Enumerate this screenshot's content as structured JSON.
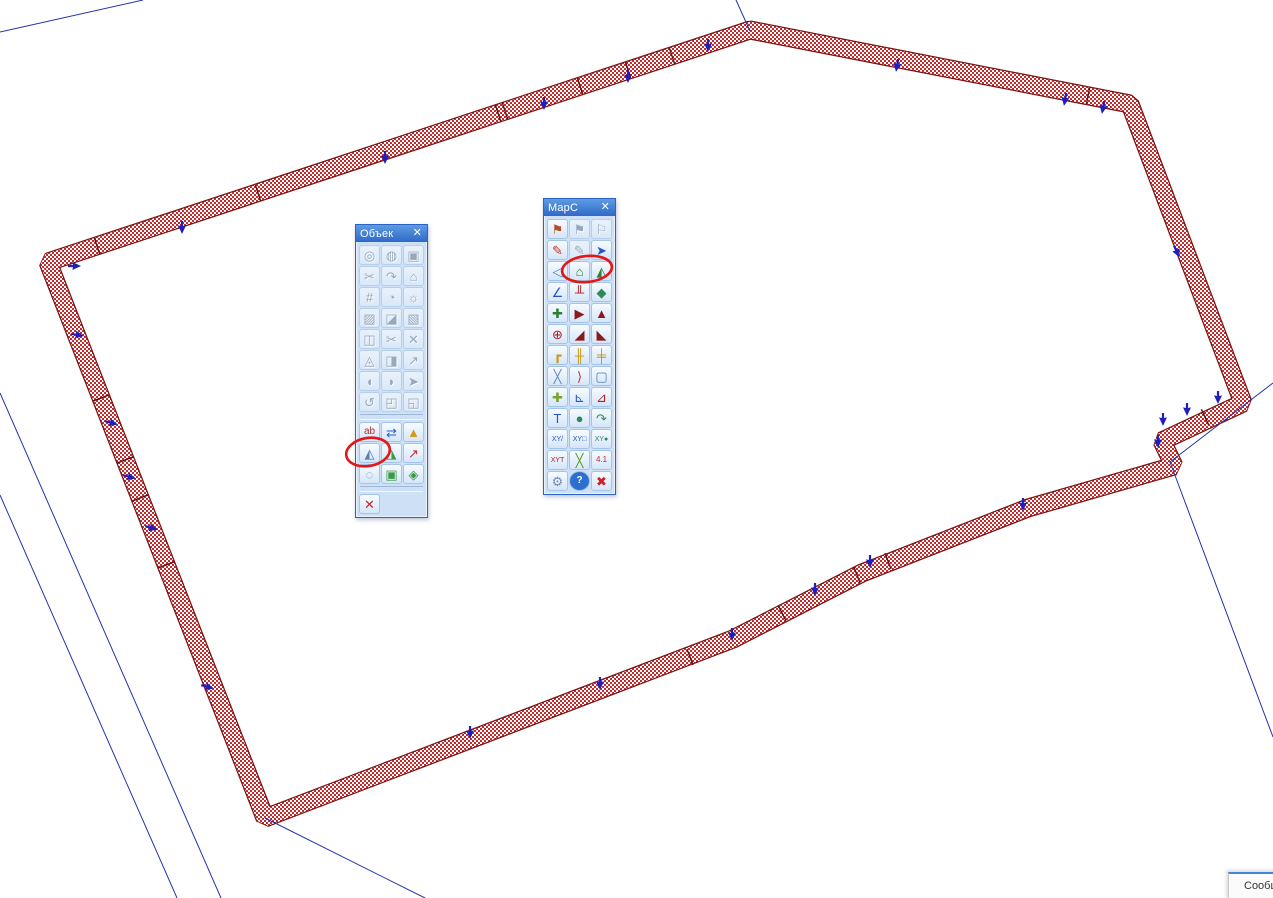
{
  "map": {
    "background": "#ffffff",
    "band": {
      "width": 16.5,
      "hatch_color": "#c42a2a",
      "outline_color": "#7a1414"
    },
    "polygon_points": [
      [
        48,
        262
      ],
      [
        750,
        30
      ],
      [
        1130,
        104
      ],
      [
        1243,
        403
      ],
      [
        1162,
        441
      ],
      [
        1174,
        466
      ],
      [
        1028,
        508
      ],
      [
        862,
        573
      ],
      [
        733,
        639
      ],
      [
        265,
        818
      ]
    ],
    "ticks": [
      [
        97,
        246,
        -18
      ],
      [
        258,
        193,
        -18
      ],
      [
        498,
        113,
        -18
      ],
      [
        505,
        111,
        -18
      ],
      [
        580,
        86,
        -18
      ],
      [
        628,
        70,
        -18
      ],
      [
        672,
        56,
        -18
      ],
      [
        1088,
        96,
        11
      ],
      [
        1205,
        417,
        155
      ],
      [
        888,
        561,
        159
      ],
      [
        857,
        575,
        159
      ],
      [
        782,
        613,
        153
      ],
      [
        690,
        657,
        159
      ],
      [
        101,
        398,
        69
      ],
      [
        125,
        460,
        69
      ],
      [
        140,
        498,
        69
      ],
      [
        166,
        565,
        69
      ]
    ],
    "tick_color": "#5d1010",
    "arrows": [
      [
        75,
        266,
        -90
      ],
      [
        78,
        335,
        -80
      ],
      [
        112,
        423,
        -75
      ],
      [
        130,
        477,
        -75
      ],
      [
        152,
        528,
        -75
      ],
      [
        208,
        687,
        -75
      ],
      [
        182,
        228,
        0
      ],
      [
        385,
        158,
        0
      ],
      [
        544,
        104,
        0
      ],
      [
        628,
        77,
        0
      ],
      [
        708,
        46,
        0
      ],
      [
        897,
        66,
        10
      ],
      [
        1065,
        100,
        10
      ],
      [
        1103,
        108,
        10
      ],
      [
        1177,
        252,
        -25
      ],
      [
        1218,
        398,
        0
      ],
      [
        1187,
        410,
        0
      ],
      [
        1163,
        420,
        0
      ],
      [
        1158,
        442,
        0
      ],
      [
        1023,
        505,
        0
      ],
      [
        870,
        562,
        0
      ],
      [
        815,
        590,
        0
      ],
      [
        732,
        635,
        0
      ],
      [
        600,
        684,
        0
      ],
      [
        470,
        733,
        0
      ]
    ],
    "arrow_color": "#1f1fbe",
    "blue_lines": [
      [
        0,
        32,
        143,
        0
      ],
      [
        736,
        0,
        750,
        31
      ],
      [
        0,
        393,
        221,
        898
      ],
      [
        0,
        495,
        177,
        898
      ],
      [
        265,
        818,
        425,
        898
      ],
      [
        1273,
        383,
        1170,
        462
      ],
      [
        1170,
        462,
        1273,
        737
      ]
    ],
    "line_color": "#2233aa",
    "annotations": {
      "color": "#e21717",
      "ellipses": [
        [
          368,
          452,
          22,
          14,
          -10
        ],
        [
          587,
          269,
          25,
          13,
          -6
        ]
      ]
    }
  },
  "toolbars": [
    {
      "title": "Объек",
      "close_glyph": "✕",
      "x": 355,
      "y": 224,
      "w": 71,
      "rows": [
        {
          "icons": [
            {
              "n": "center-point-icon",
              "g": "◎",
              "d": 1
            },
            {
              "n": "hatched-circle-icon",
              "g": "◍",
              "d": 1
            },
            {
              "n": "copy-object-icon",
              "g": "▣",
              "d": 1
            }
          ]
        },
        {
          "icons": [
            {
              "n": "cut-object-icon",
              "g": "✂",
              "d": 1
            },
            {
              "n": "smooth-arc-icon",
              "g": "↷",
              "d": 1
            },
            {
              "n": "move-contour-icon",
              "g": "⌂",
              "d": 1
            }
          ]
        },
        {
          "icons": [
            {
              "n": "grid-icon",
              "g": "#",
              "d": 1
            },
            {
              "n": "fill-area-icon",
              "g": "◔",
              "d": 1
            },
            {
              "n": "gear-area-icon",
              "g": "☼",
              "d": 1
            }
          ]
        },
        {
          "icons": [
            {
              "n": "hatch-square-icon",
              "g": "▨",
              "d": 1
            },
            {
              "n": "hatch-corner-icon",
              "g": "◪",
              "d": 1
            },
            {
              "n": "hatch-diag-icon",
              "g": "▧",
              "d": 1
            }
          ]
        },
        {
          "icons": [
            {
              "n": "frame-edit-icon",
              "g": "◫",
              "d": 1
            },
            {
              "n": "cut-line-icon",
              "g": "✂",
              "d": 1
            },
            {
              "n": "delete-node-icon",
              "g": "✕",
              "d": 1
            }
          ]
        },
        {
          "icons": [
            {
              "n": "query-area-icon",
              "g": "◬",
              "d": 1
            },
            {
              "n": "merge-area-icon",
              "g": "◨",
              "d": 1
            },
            {
              "n": "split-line-icon",
              "g": "↗",
              "d": 1
            }
          ]
        },
        {
          "icons": [
            {
              "n": "contour-left-icon",
              "g": "◖",
              "d": 1
            },
            {
              "n": "contour-right-icon",
              "g": "◗",
              "d": 1
            },
            {
              "n": "contour-arrow-icon",
              "g": "➤",
              "d": 1
            }
          ]
        },
        {
          "icons": [
            {
              "n": "undo-contour-icon",
              "g": "↺",
              "d": 1
            },
            {
              "n": "copy-frame-icon",
              "g": "◰",
              "d": 1
            },
            {
              "n": "paste-frame-icon",
              "g": "◱",
              "d": 1
            }
          ]
        },
        {
          "divider": true
        },
        {
          "icons": [
            {
              "n": "label-ab-icon",
              "g": "ab",
              "c": "#b03030",
              "s": 10
            },
            {
              "n": "move-vertices-icon",
              "g": "⇄",
              "c": "#2a5fd0"
            },
            {
              "n": "edit-polygon-icon",
              "g": "▲",
              "c": "#d49a1a"
            }
          ]
        },
        {
          "icons": [
            {
              "n": "hatch-polygon-cut-icon",
              "g": "◭",
              "c": "#5b7fb0"
            },
            {
              "n": "double-polygon-icon",
              "g": "◮",
              "c": "#3a9a4a"
            },
            {
              "n": "direction-arrow-icon",
              "g": "↗",
              "c": "#c03030"
            }
          ]
        },
        {
          "icons": [
            {
              "n": "lasso-icon",
              "g": "◌",
              "c": "#7b8bb0"
            },
            {
              "n": "insert-object-icon",
              "g": "▣",
              "c": "#3a9a4a"
            },
            {
              "n": "flag-polygon-icon",
              "g": "◈",
              "c": "#3a9a4a"
            }
          ]
        },
        {
          "divider": true
        },
        {
          "icons": [
            {
              "n": "cancel-edit-icon",
              "g": "✕",
              "c": "#cc2222"
            }
          ]
        }
      ]
    },
    {
      "title": "MapC",
      "close_glyph": "✕",
      "x": 543,
      "y": 198,
      "w": 71,
      "rows": [
        {
          "icons": [
            {
              "n": "stamp-flag-icon",
              "g": "⚑",
              "c": "#b2502a"
            },
            {
              "n": "stamp-gray-icon",
              "g": "⚑",
              "d": 1
            },
            {
              "n": "stamp-list-icon",
              "g": "⚐",
              "d": 1
            }
          ]
        },
        {
          "icons": [
            {
              "n": "brush-icon",
              "g": "✎",
              "c": "#c0392b"
            },
            {
              "n": "brush-gray-icon",
              "g": "✎",
              "d": 1
            },
            {
              "n": "pick-pencil-icon",
              "g": "➤",
              "c": "#2457c5"
            }
          ]
        },
        {
          "icons": [
            {
              "n": "triangle-left-icon",
              "g": "◁",
              "c": "#4a7ebb"
            },
            {
              "n": "create-object-icon",
              "g": "⌂",
              "c": "#2e7d32"
            },
            {
              "n": "split-surface-icon",
              "g": "◭",
              "c": "#2e7d32"
            }
          ]
        },
        {
          "icons": [
            {
              "n": "angle-icon",
              "g": "∠",
              "c": "#2457c5"
            },
            {
              "n": "rail-marks-icon",
              "g": "╨",
              "c": "#b02020"
            },
            {
              "n": "diamond-icon",
              "g": "◆",
              "c": "#2e8b57"
            }
          ]
        },
        {
          "icons": [
            {
              "n": "add-point-line-icon",
              "g": "✚",
              "c": "#2e7d32"
            },
            {
              "n": "flag-right-icon",
              "g": "▶",
              "c": "#8b1a1a"
            },
            {
              "n": "slope-icon",
              "g": "▲",
              "c": "#8b1a1a"
            }
          ]
        },
        {
          "icons": [
            {
              "n": "center-cross-icon",
              "g": "⊕",
              "c": "#b02020"
            },
            {
              "n": "double-slope-icon",
              "g": "◢",
              "c": "#8b1a1a"
            },
            {
              "n": "slope-base-icon",
              "g": "◣",
              "c": "#8b1a1a"
            }
          ]
        },
        {
          "icons": [
            {
              "n": "pipe-corner-icon",
              "g": "┏",
              "c": "#c8960c"
            },
            {
              "n": "align-width-icon",
              "g": "╫",
              "c": "#c8960c"
            },
            {
              "n": "align-height-icon",
              "g": "╪",
              "c": "#c8960c"
            }
          ]
        },
        {
          "icons": [
            {
              "n": "cross-lines-icon",
              "g": "╳",
              "c": "#6a8ab8"
            },
            {
              "n": "curve-right-icon",
              "g": "⟩",
              "c": "#c03030"
            },
            {
              "n": "select-contour-icon",
              "g": "▢",
              "c": "#4a7ebb"
            }
          ]
        },
        {
          "icons": [
            {
              "n": "add-node-icon",
              "g": "✚",
              "c": "#7aa22a"
            },
            {
              "n": "angle-arc-icon",
              "g": "⊾",
              "c": "#2457c5"
            },
            {
              "n": "angle-arc-red-icon",
              "g": "⊿",
              "c": "#b02020"
            }
          ]
        },
        {
          "icons": [
            {
              "n": "text-table-icon",
              "g": "T",
              "c": "#2457c5"
            },
            {
              "n": "sphere-icon",
              "g": "●",
              "c": "#2e8b57"
            },
            {
              "n": "curve-arrow-icon",
              "g": "↷",
              "c": "#2e8b57"
            }
          ]
        },
        {
          "icons": [
            {
              "n": "xy-line-icon",
              "g": "XY/",
              "c": "#2457c5",
              "s": 7
            },
            {
              "n": "xy-contour-icon",
              "g": "XY□",
              "c": "#2457c5",
              "s": 7
            },
            {
              "n": "xy-point-icon",
              "g": "XY●",
              "c": "#2e8b57",
              "s": 7
            }
          ]
        },
        {
          "icons": [
            {
              "n": "xy-text-icon",
              "g": "XYT",
              "c": "#b02020",
              "s": 7
            },
            {
              "n": "dashed-cross-icon",
              "g": "╳",
              "c": "#5a9a2a"
            },
            {
              "n": "coord-list-icon",
              "g": "4.1",
              "c": "#c03030",
              "s": 8
            }
          ]
        },
        {
          "icons": [
            {
              "n": "wrench-icon",
              "g": "⚙",
              "c": "#7b8bb0"
            },
            {
              "n": "help-icon",
              "g": "?",
              "c": "#ffffff",
              "bg": "#2d6fd0",
              "s": 10
            },
            {
              "n": "exit-icon",
              "g": "✖",
              "c": "#cc2222"
            }
          ]
        }
      ]
    }
  ],
  "message_window": {
    "label": "Сообщ"
  }
}
